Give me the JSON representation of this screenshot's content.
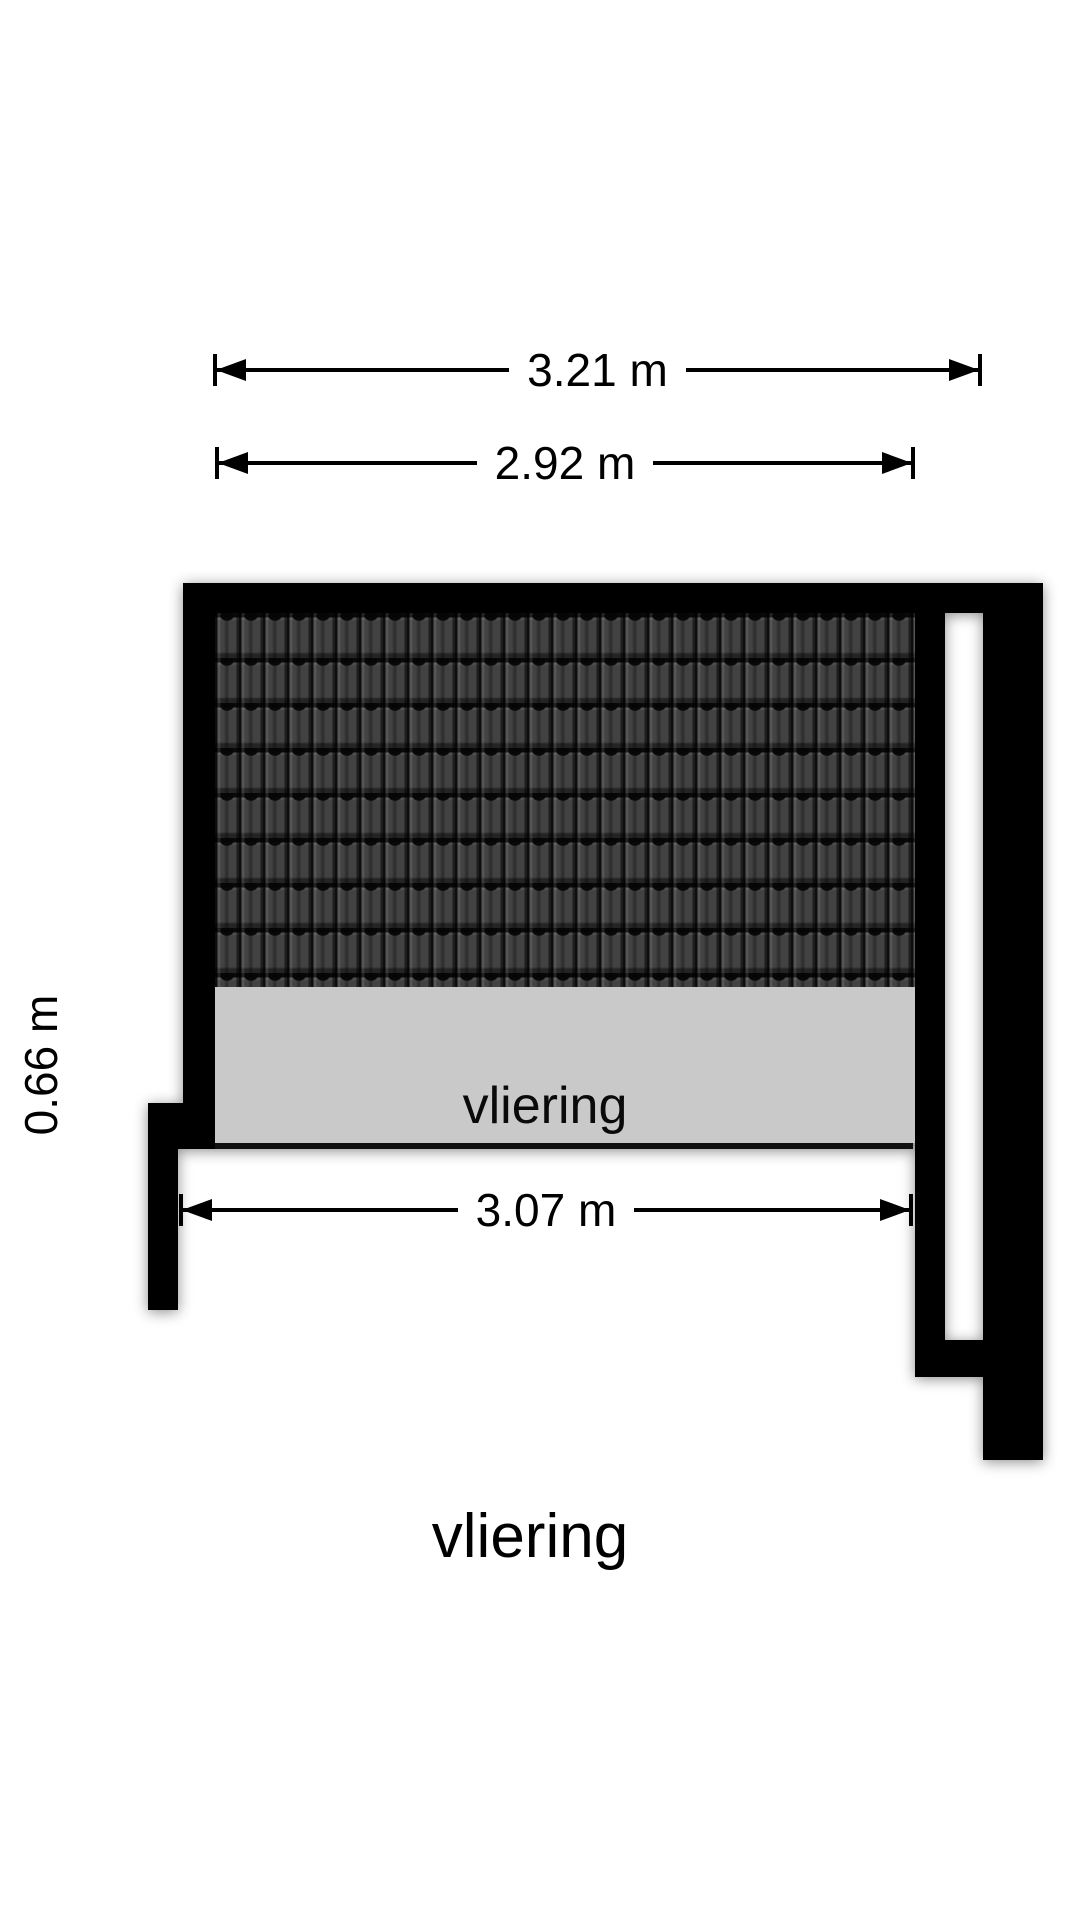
{
  "title": "vliering",
  "room": {
    "label": "vliering"
  },
  "dimensions": [
    {
      "id": "overall-width-top",
      "label": "3.21 m"
    },
    {
      "id": "inner-width-top",
      "label": "2.92 m"
    },
    {
      "id": "floor-width-bottom",
      "label": "3.07 m"
    },
    {
      "id": "floor-depth-side",
      "label": "0.66 m"
    }
  ],
  "colors": {
    "wall": "#000000",
    "roof_tile": "#424242",
    "floor": "#c9c9c9",
    "background": "#ffffff"
  }
}
